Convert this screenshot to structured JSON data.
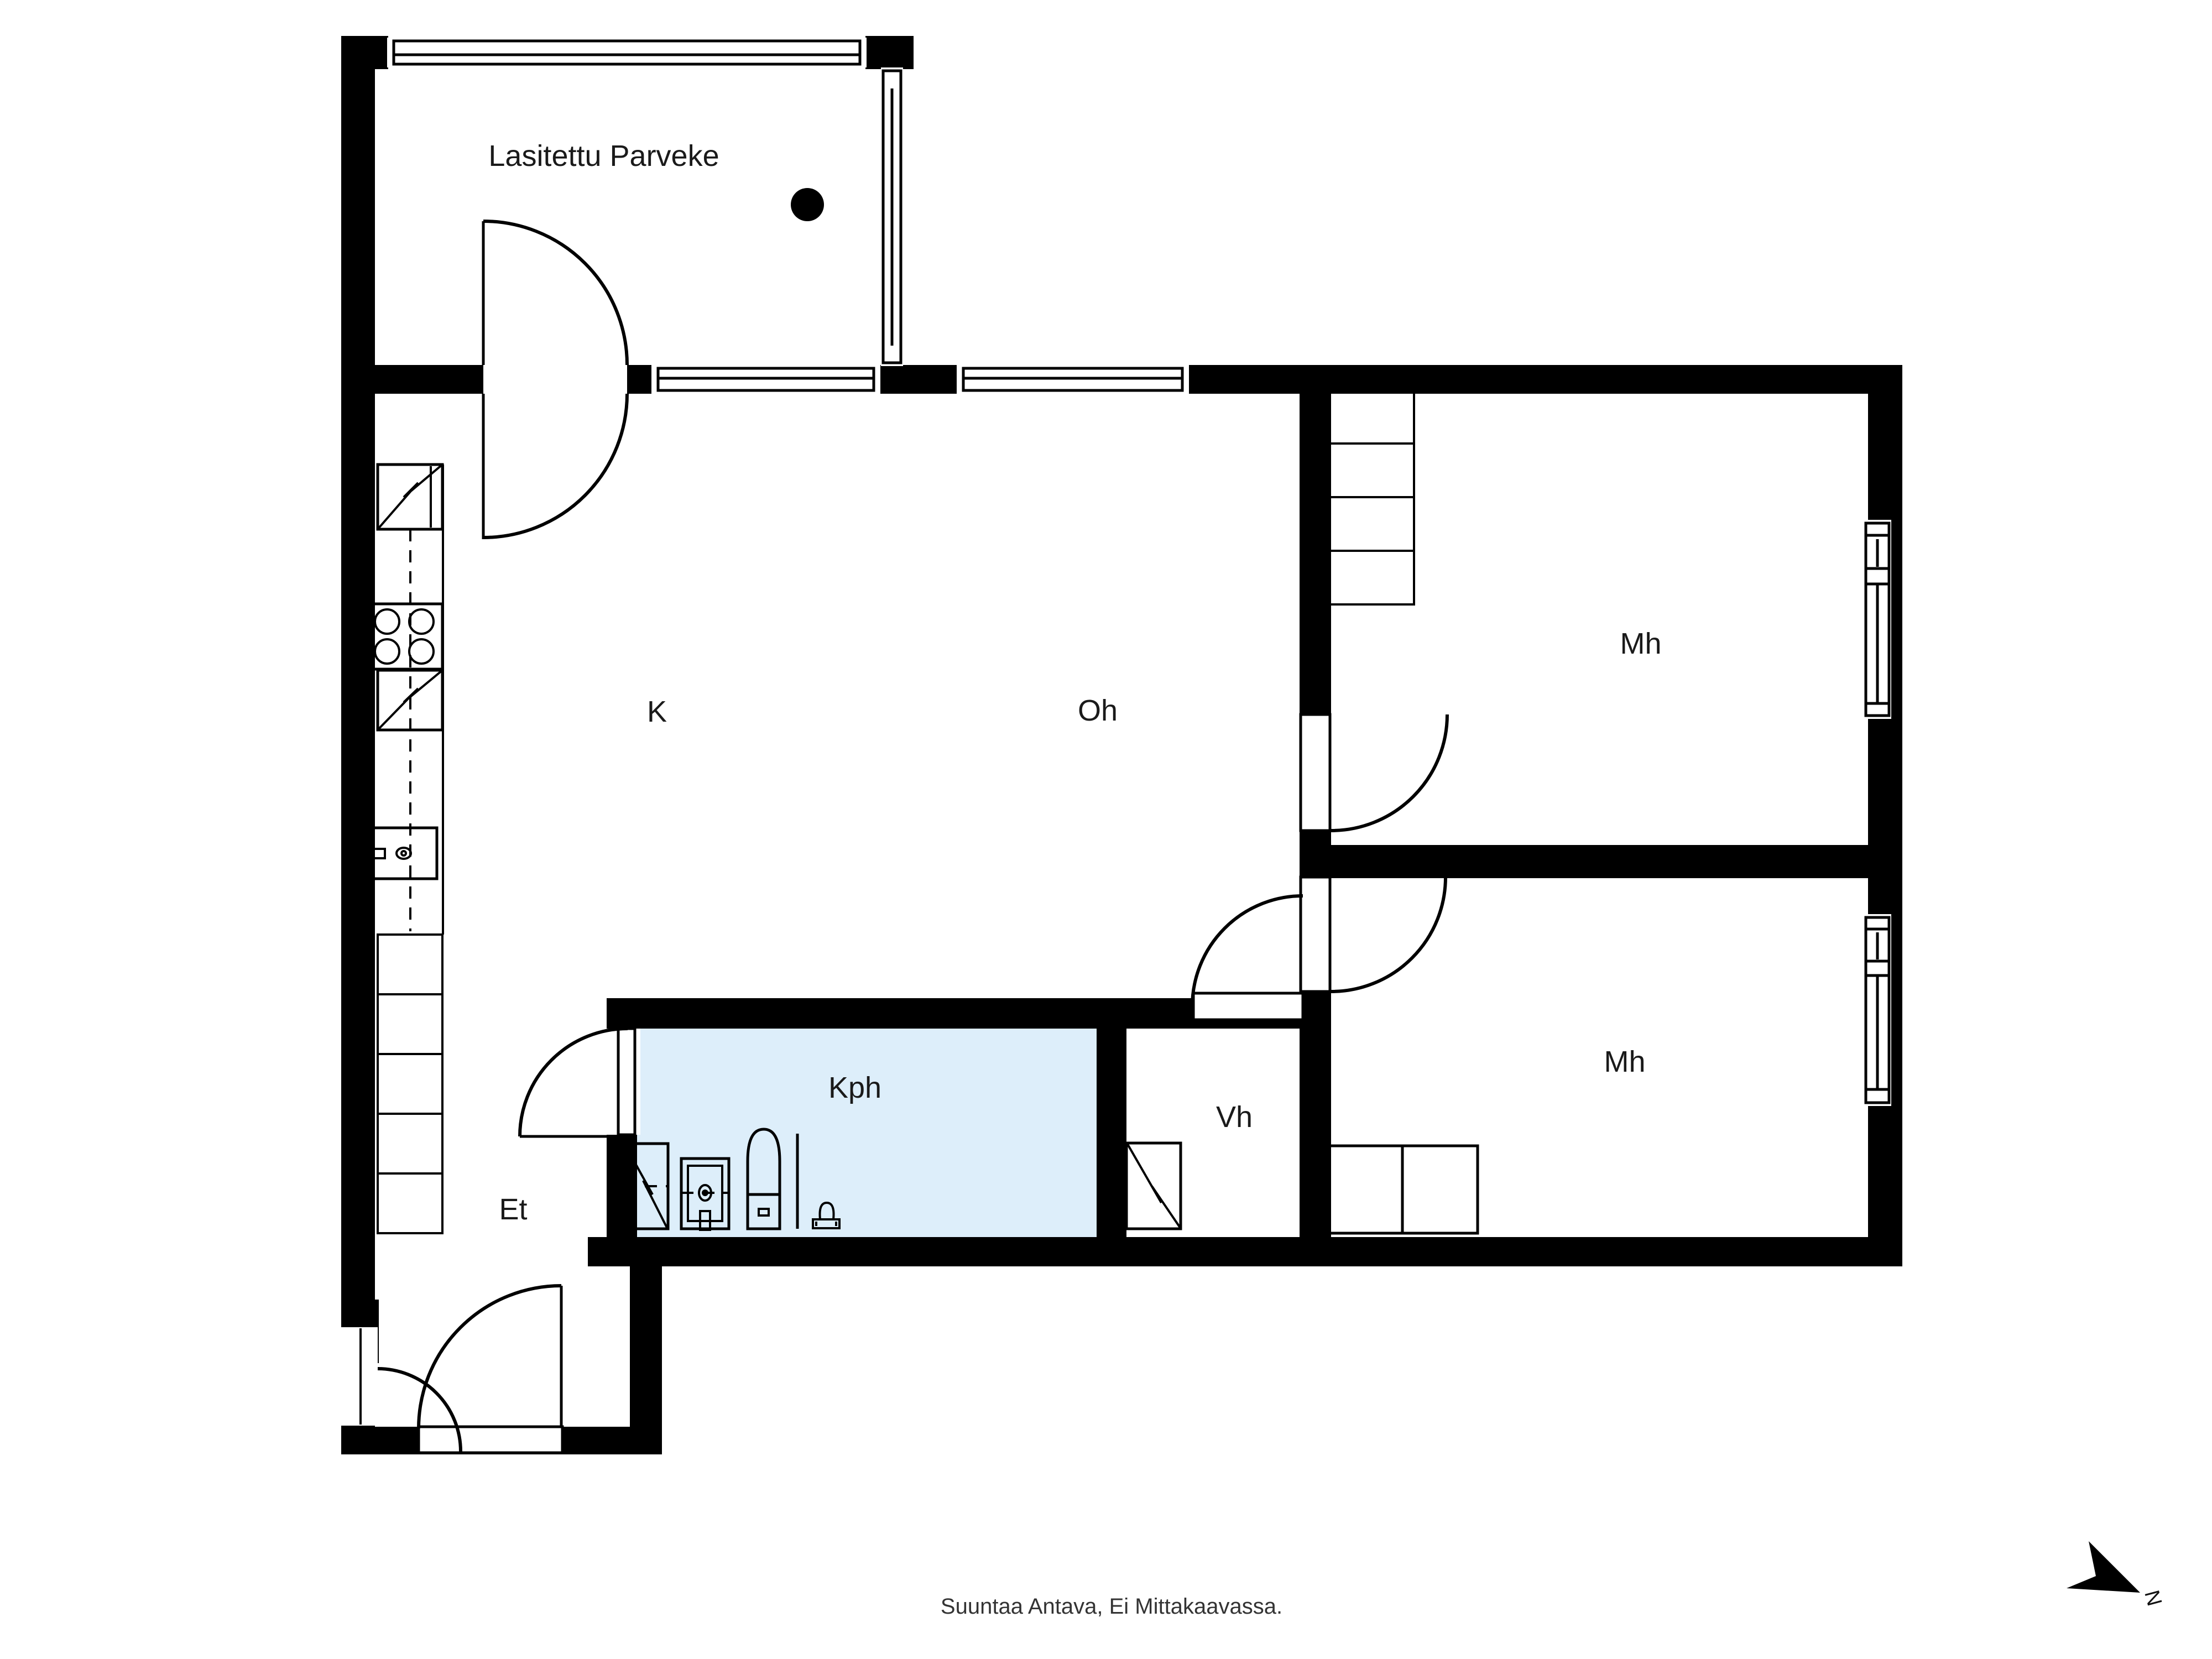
{
  "rooms": {
    "balcony": {
      "label": "Lasitettu Parveke"
    },
    "kitchen": {
      "label": "K"
    },
    "living_room": {
      "label": "Oh"
    },
    "bedroom_top": {
      "label": "Mh"
    },
    "bedroom_bottom": {
      "label": "Mh"
    },
    "bathroom": {
      "label": "Kph"
    },
    "closet": {
      "label": "Vh"
    },
    "entry": {
      "label": "Et"
    }
  },
  "footer": {
    "disclaimer": "Suuntaa Antava, Ei Mittakaavassa."
  },
  "compass": {
    "north_label": "N"
  },
  "colors": {
    "wall": "#000000",
    "background": "#ffffff",
    "bathroom_fill": "#ddeefa",
    "text": "#1a1a1a"
  }
}
